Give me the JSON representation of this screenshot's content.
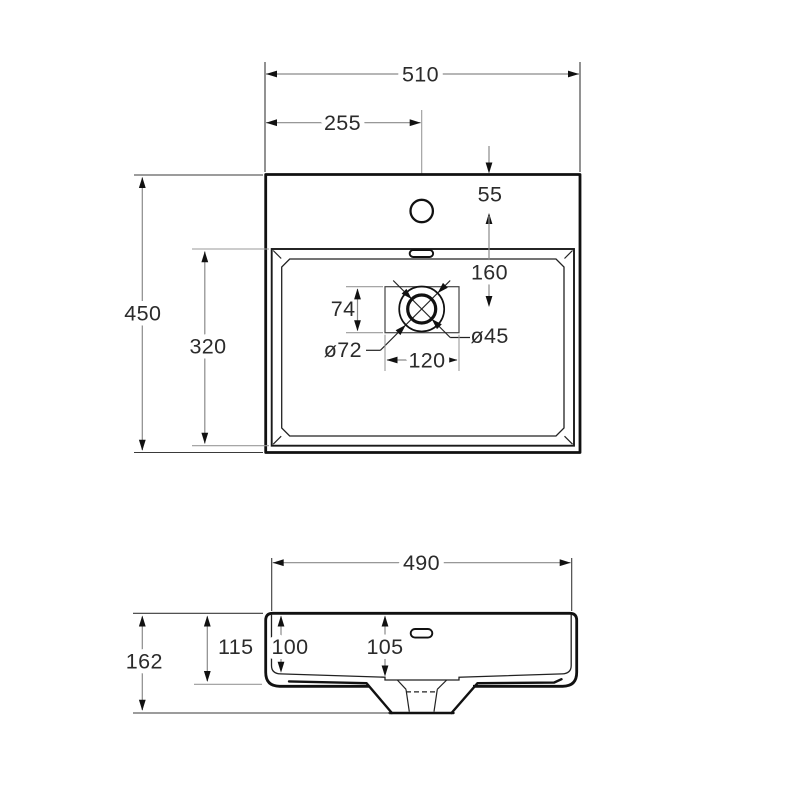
{
  "drawing": {
    "type": "washbasin-technical-drawing",
    "colors": {
      "outline": "#111111",
      "dimension_line": "#8a8a8a",
      "text": "#2b2b2b",
      "background": "#ffffff"
    },
    "top_view": {
      "overall_width_label": "510",
      "faucet_center_offset_label": "255",
      "faucet_edge_distance_label": "55",
      "faucet_to_drain_label": "160",
      "overall_depth_label": "450",
      "basin_inner_depth_label": "320",
      "drain_recess_height_label": "74",
      "drain_recess_width_label": "120",
      "drain_outer_diameter_label": "ø72",
      "drain_inner_diameter_label": "ø45"
    },
    "front_view": {
      "top_width_label": "490",
      "total_height_label": "162",
      "body_height_label": "115",
      "inner_depth_label": "100",
      "recess_depth_label": "105"
    }
  }
}
